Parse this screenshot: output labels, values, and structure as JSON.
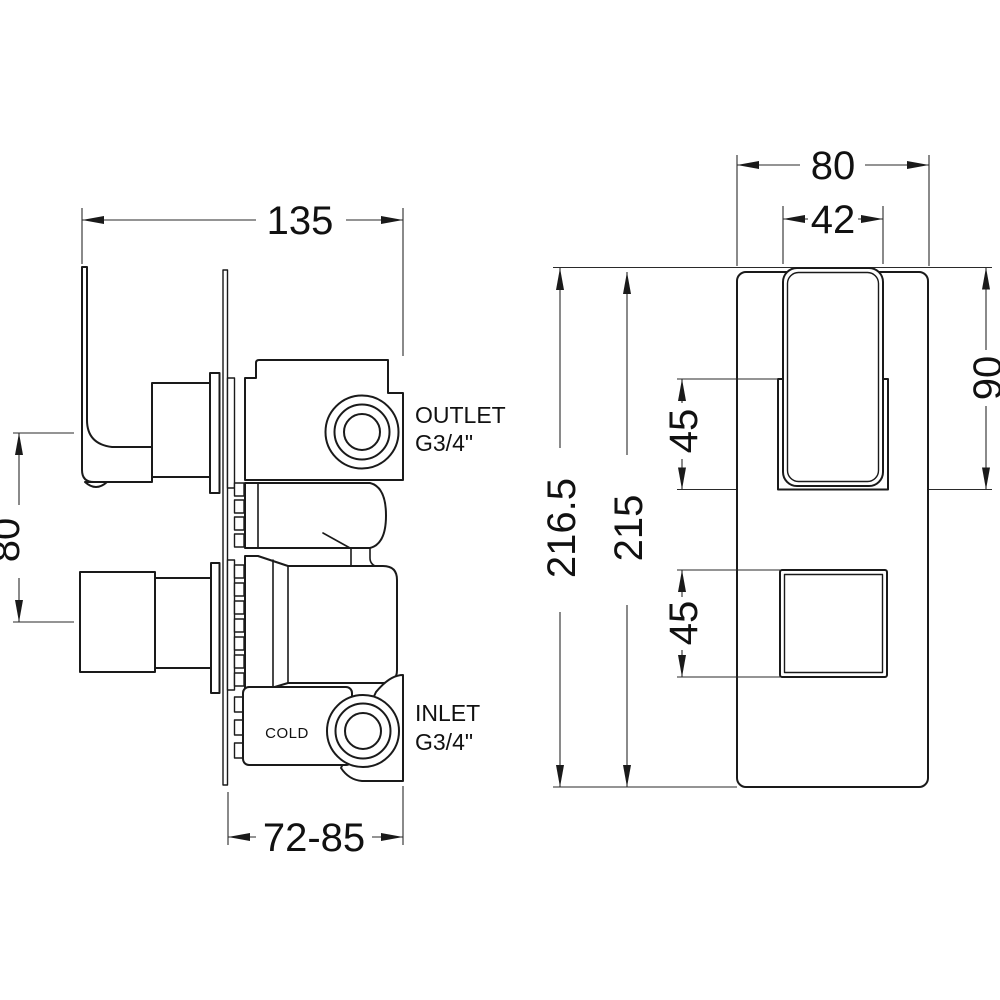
{
  "drawing": {
    "description": "Technical dimension drawing of concealed thermostatic shower valve, side view and front view",
    "colors": {
      "line": "#1a1a1a",
      "background": "#ffffff"
    },
    "side_view": {
      "dim_width": "135",
      "dim_handle_centres": "80",
      "dim_depth_range": "72-85",
      "outlet_label_line1": "OUTLET",
      "outlet_label_line2": "G3/4\"",
      "inlet_label_line1": "INLET",
      "inlet_label_line2": "G3/4\"",
      "cold_label": "COLD"
    },
    "front_view": {
      "dim_plate_width": "80",
      "dim_handle_width": "42",
      "dim_total_height": "216.5",
      "dim_plate_height": "215",
      "dim_upper_square": "45",
      "dim_lower_square": "45",
      "dim_handle_height": "90"
    }
  }
}
